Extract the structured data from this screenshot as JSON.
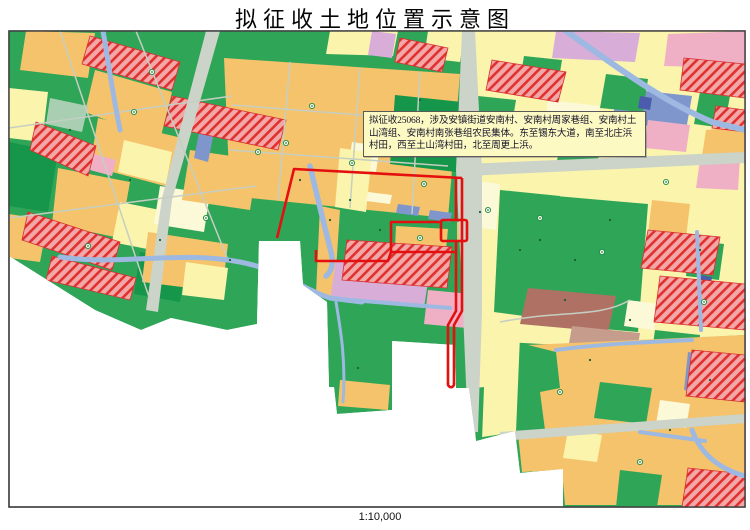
{
  "page": {
    "title": "拟征收土地位置示意图",
    "scale_label": "1:10,000",
    "background": "#ffffff"
  },
  "callout": {
    "text": "拟征收25068，涉及安镇街道安南村、安南村周家巷组、安南村土山湾组、安南村南张巷组农民集体。东至锡东大道，南至北庄浜村田，西至土山湾村田，北至周更上浜。",
    "background": "#fdf9c3",
    "border_color": "#5a5a5a"
  },
  "map": {
    "frame_border_color": "#3c3c3c",
    "acquisition_boundary_color": "#e40f0f",
    "palette": {
      "farmland_orange": "#f5c36b",
      "forest_green": "#2fa558",
      "dark_green": "#15964a",
      "pale_yellow": "#faf4ad",
      "cream": "#fcf9d8",
      "construction_hatch_bg": "#f3a8a8",
      "construction_hatch_line": "#e03030",
      "lavender": "#d8aed8",
      "pink": "#efb0c6",
      "water_blue": "#9db9e2",
      "slate_blue": "#7e96cc",
      "road_gray": "#ccd3c8",
      "brown": "#ae7164",
      "light_brown": "#c69c8c",
      "pale_teal": "#a8cfb2",
      "unmapped_white": "#ffffff"
    }
  }
}
